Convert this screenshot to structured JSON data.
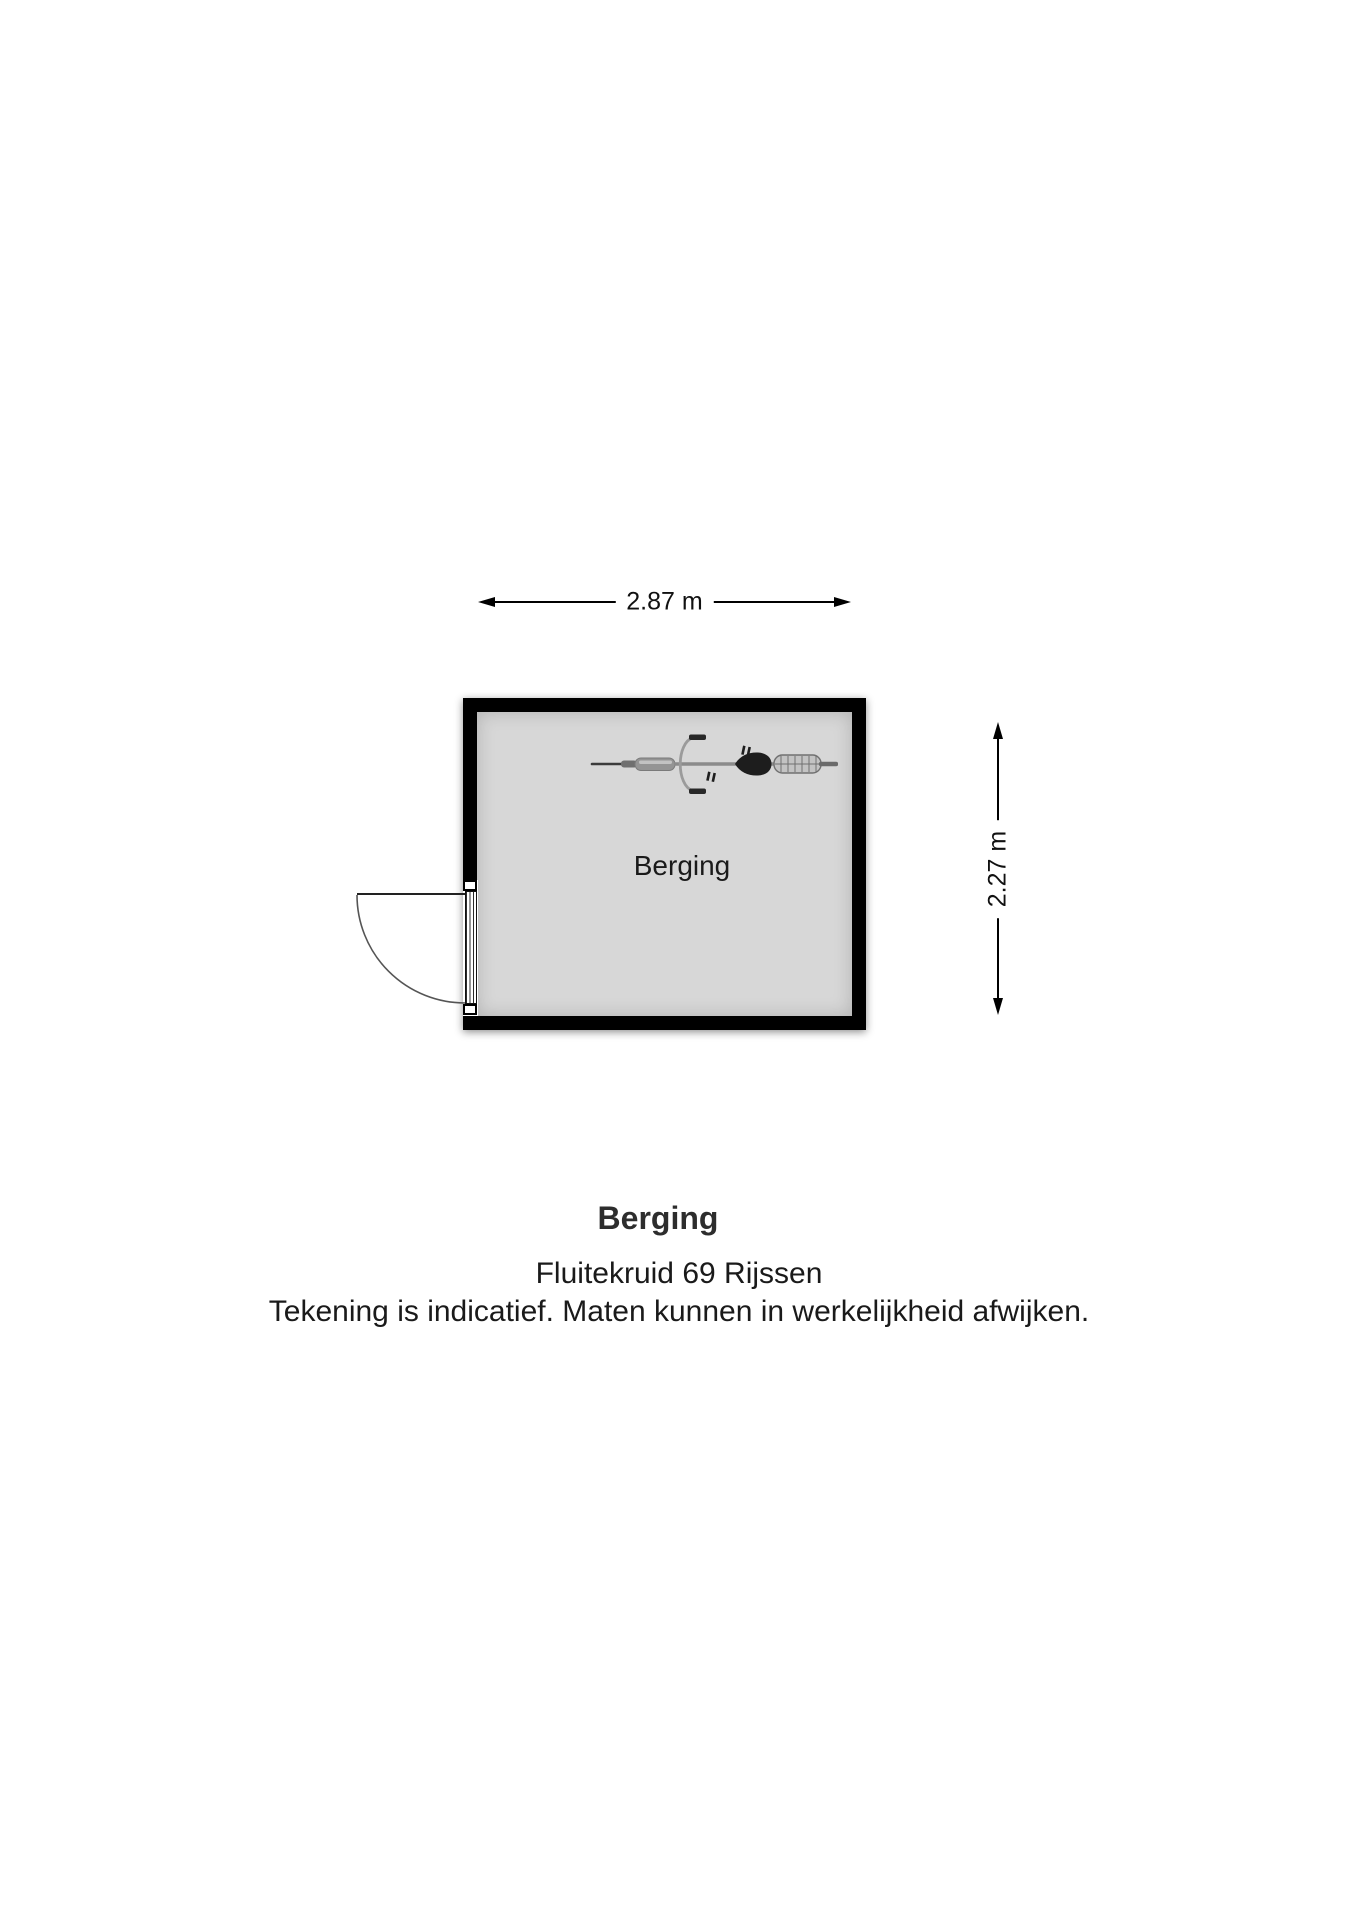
{
  "floorplan": {
    "room_label": "Berging",
    "width_dimension": "2.87 m",
    "height_dimension": "2.27 m",
    "colors": {
      "wall": "#000000",
      "floor": "#d7d7d7",
      "background": "#ffffff",
      "dimension_text": "#111111"
    },
    "door": {
      "wall": "left",
      "swing": "outward"
    },
    "furniture": [
      {
        "name": "bicycle",
        "description": "bicycle top view"
      }
    ]
  },
  "caption": {
    "title": "Berging",
    "address": "Fluitekruid 69 Rijssen",
    "disclaimer": "Tekening is indicatief. Maten kunnen in werkelijkheid afwijken."
  }
}
